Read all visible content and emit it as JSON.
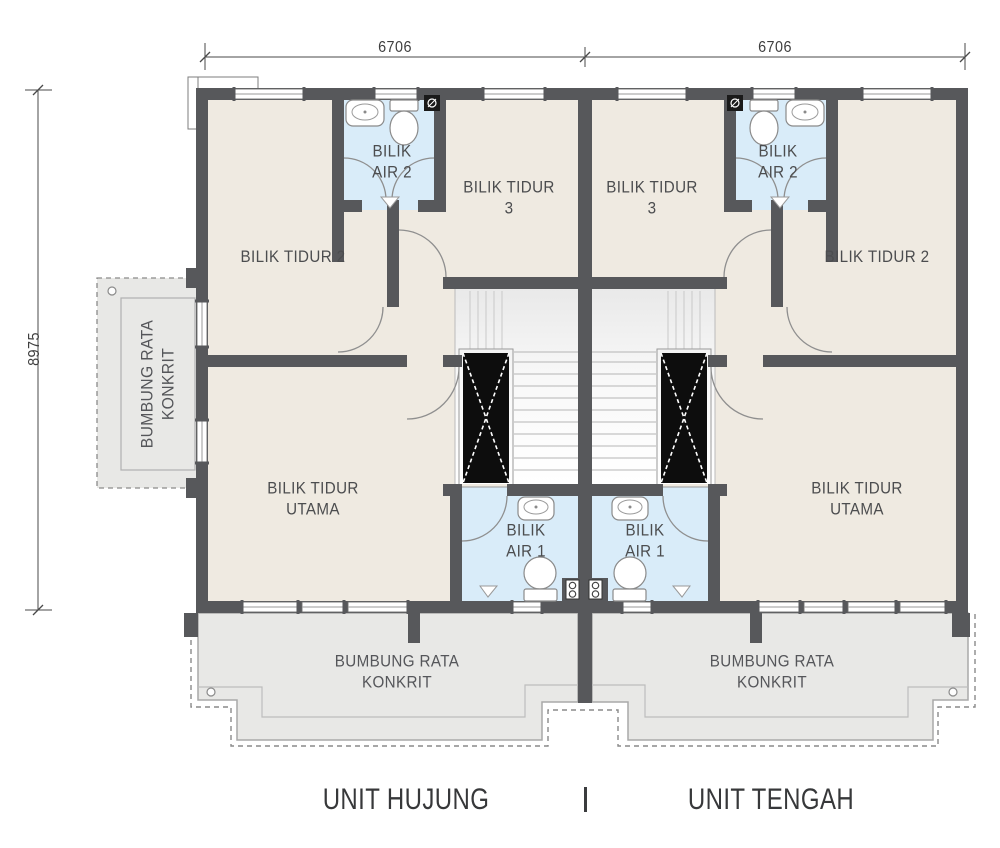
{
  "dimensions": {
    "top_left": "6706",
    "top_right": "6706",
    "left_height": "8975"
  },
  "units": {
    "left": "UNIT HUJUNG",
    "right": "UNIT TENGAH"
  },
  "rooms": {
    "bedroom2": "BILIK TIDUR 2",
    "bedroom3_line1": "BILIK TIDUR",
    "bedroom3_line2": "3",
    "master_line1": "BILIK TIDUR",
    "master_line2": "UTAMA",
    "bath2_line1": "BILIK",
    "bath2_line2": "AIR 2",
    "bath1_line1": "BILIK",
    "bath1_line2": "AIR 1"
  },
  "annotations": {
    "flat_roof_line1": "BUMBUNG RATA",
    "flat_roof_line2": "KONKRIT",
    "flat_roof_side_line1": "BUMBUNG RATA",
    "flat_roof_side_line2": "KONKRIT"
  },
  "colors": {
    "wall": "#57585b",
    "floor": "#efeae1",
    "bathroom_floor": "#d9ecf9",
    "roof": "#e8e8e6",
    "void_black": "#0d0d0d",
    "text": "#4c4d4f"
  }
}
